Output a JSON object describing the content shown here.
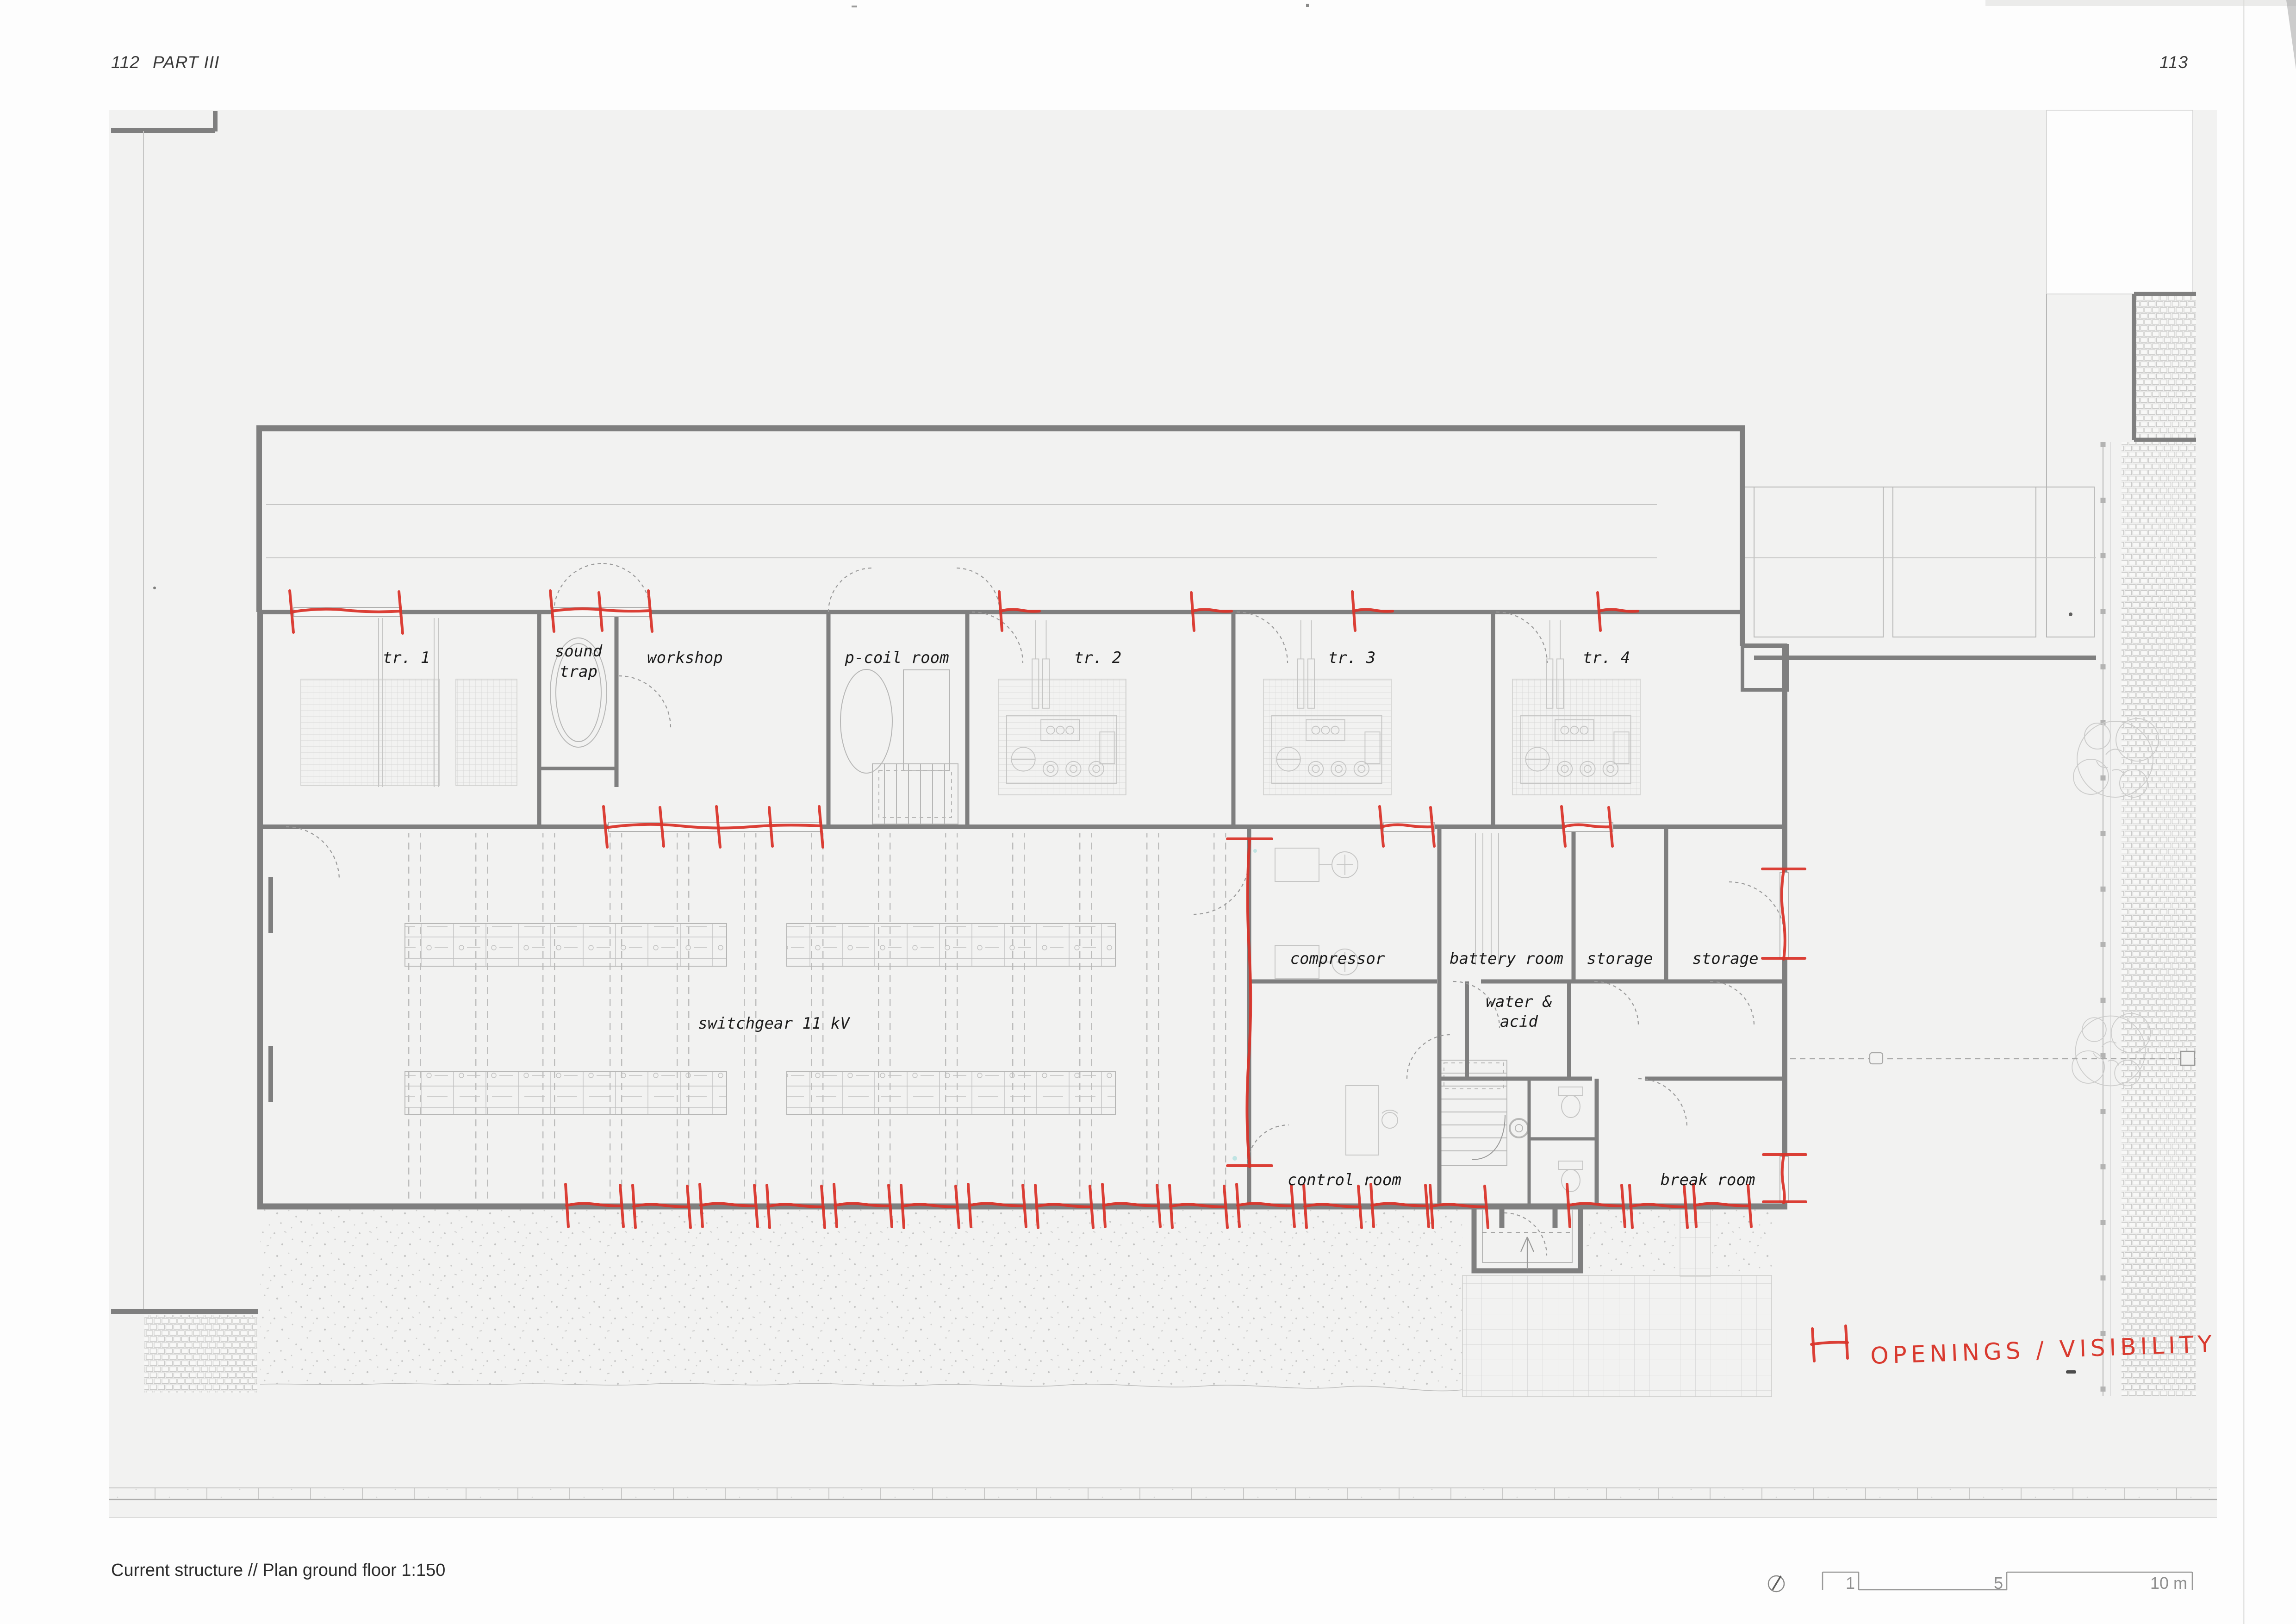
{
  "page": {
    "folio_left_num": "112",
    "folio_left_part": "PART III",
    "folio_right": "113",
    "caption": "Current structure // Plan ground floor 1:150"
  },
  "rooms": {
    "tr1": "tr. 1",
    "sound_trap_line1": "sound",
    "sound_trap_line2": "trap",
    "workshop": "workshop",
    "pcoil": "p-coil room",
    "tr2": "tr. 2",
    "tr3": "tr. 3",
    "tr4": "tr. 4",
    "compressor": "compressor",
    "battery": "battery room",
    "storage1": "storage",
    "storage2": "storage",
    "water_line1": "water &",
    "water_line2": "acid",
    "switchgear": "switchgear 11 kV",
    "control": "control room",
    "breakroom": "break room"
  },
  "legend": {
    "text": "OPENINGS / VISIBILITY",
    "marker_meaning": "red opening/visibility mark"
  },
  "scalebar": {
    "one": "1",
    "five": "5",
    "ten": "10 m"
  },
  "colors": {
    "page_bg": "#fdfdfd",
    "site_bg": "#f2f2f1",
    "wall": "#7f7f7f",
    "thin_line": "#b7b7b6",
    "equipment": "#c6c6c5",
    "annotation_red": "#d9352b",
    "label_text": "#1b1b1b",
    "muted_text": "#8f8f8f"
  }
}
